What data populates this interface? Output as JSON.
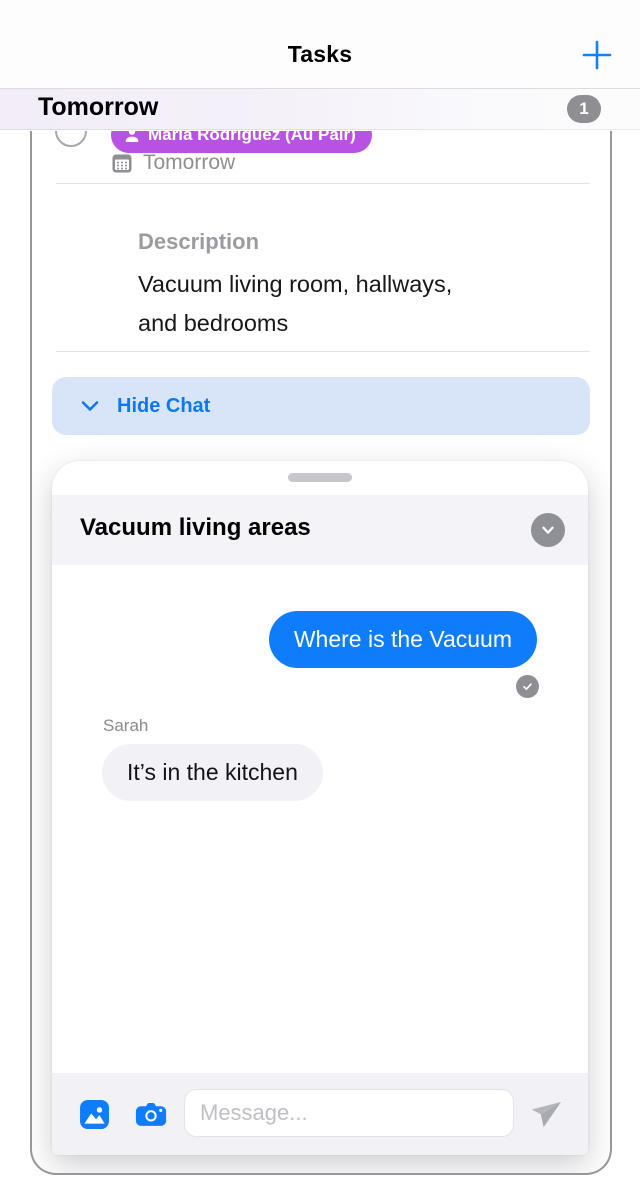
{
  "nav": {
    "title": "Tasks"
  },
  "section": {
    "title": "Tomorrow",
    "badge": "1"
  },
  "task": {
    "assignee": "Maria Rodriguez (Au Pair)",
    "due": "Tomorrow",
    "description_label": "Description",
    "description": "Vacuum living room, hallways, and bedrooms",
    "hide_chat_label": "Hide Chat"
  },
  "chat": {
    "title": "Vacuum living areas",
    "messages": [
      {
        "from": "me",
        "text": "Where is the Vacuum",
        "status": "delivered"
      },
      {
        "from": "them",
        "sender": "Sarah",
        "text": "It’s in the kitchen"
      }
    ],
    "input_placeholder": "Message..."
  },
  "icons": {
    "add": "plus-icon",
    "assignee": "person-icon",
    "due": "calendar-icon",
    "hide_chat": "chevron-down-icon",
    "collapse": "chevron-down-circle-icon",
    "delivered": "checkmark-icon",
    "photo": "photo-icon",
    "camera": "camera-icon",
    "send": "paper-plane-icon"
  },
  "colors": {
    "accent_blue": "#0f7cfb",
    "assignee_pill": "#b852e2",
    "badge_gray": "#8e8e93",
    "outgoing_bubble": "#0f7cfb",
    "incoming_bubble": "#f2f1f6",
    "hide_chat_bg": "#d8e5f8",
    "card_border": "#97979c"
  }
}
